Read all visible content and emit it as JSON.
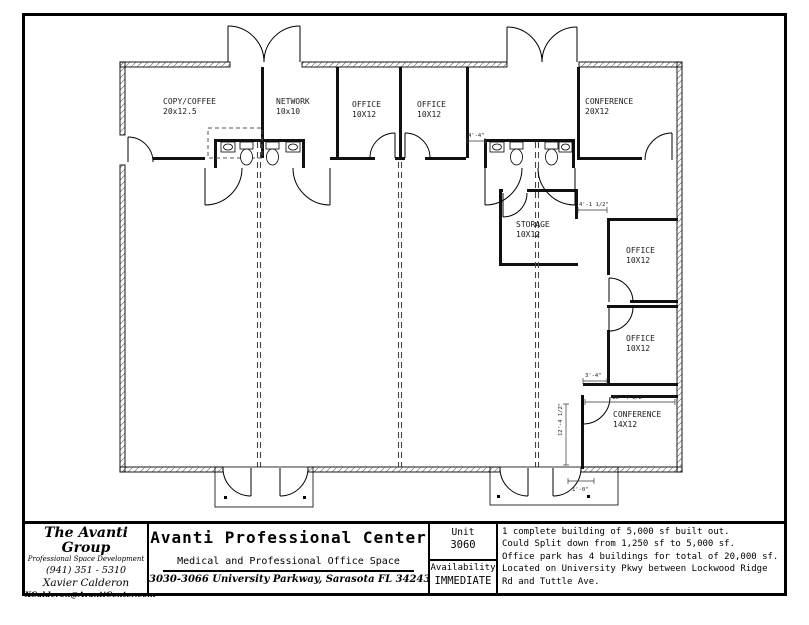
{
  "plan": {
    "rooms": [
      {
        "name": "COPY/COFFEE",
        "size": "20x12.5"
      },
      {
        "name": "NETWORK",
        "size": "10x10"
      },
      {
        "name": "OFFICE",
        "size": "10X12"
      },
      {
        "name": "OFFICE",
        "size": "10X12"
      },
      {
        "name": "CONFERENCE",
        "size": "20X12"
      },
      {
        "name": "STORAGE",
        "size": "10X12"
      },
      {
        "name": "OFFICE",
        "size": "10X12"
      },
      {
        "name": "OFFICE",
        "size": "10X12"
      },
      {
        "name": "CONFERENCE",
        "size": "14X12"
      }
    ],
    "dimensions": [
      {
        "text": "4'-4\""
      },
      {
        "text": "4'-1 1/2\""
      },
      {
        "text": "3'-4\""
      },
      {
        "text": "13'-4 1/2\""
      },
      {
        "text": "12'-4 1/2\""
      },
      {
        "text": "1'-0\""
      }
    ],
    "colors": {
      "wall": "#000000",
      "hatch": "#777777",
      "dashed": "#444444",
      "label": "#1a1a1a"
    }
  },
  "title_block": {
    "company": {
      "name": "The Avanti Group",
      "tagline": "Professional Space Development",
      "phone": "(941) 351 - 5310",
      "contact": "Xavier Calderon",
      "email": "XCalderon@AvantiCenter.com"
    },
    "project": {
      "title": "Avanti Professional Center",
      "subtitle": "Medical and Professional Office Space",
      "address": "3030-3066 University Parkway, Sarasota FL 34243"
    },
    "unit": {
      "label": "Unit",
      "number": "3060",
      "availability_label": "Availability",
      "availability_value": "IMMEDIATE"
    },
    "notes": [
      "1 complete building of 5,000 sf built out.",
      "Could Split down from 1,250 sf to 5,000 sf.",
      "Office park has 4 buildings for total of 20,000 sf.",
      "Located on University Pkwy between Lockwood Ridge Rd and Tuttle Ave."
    ]
  }
}
